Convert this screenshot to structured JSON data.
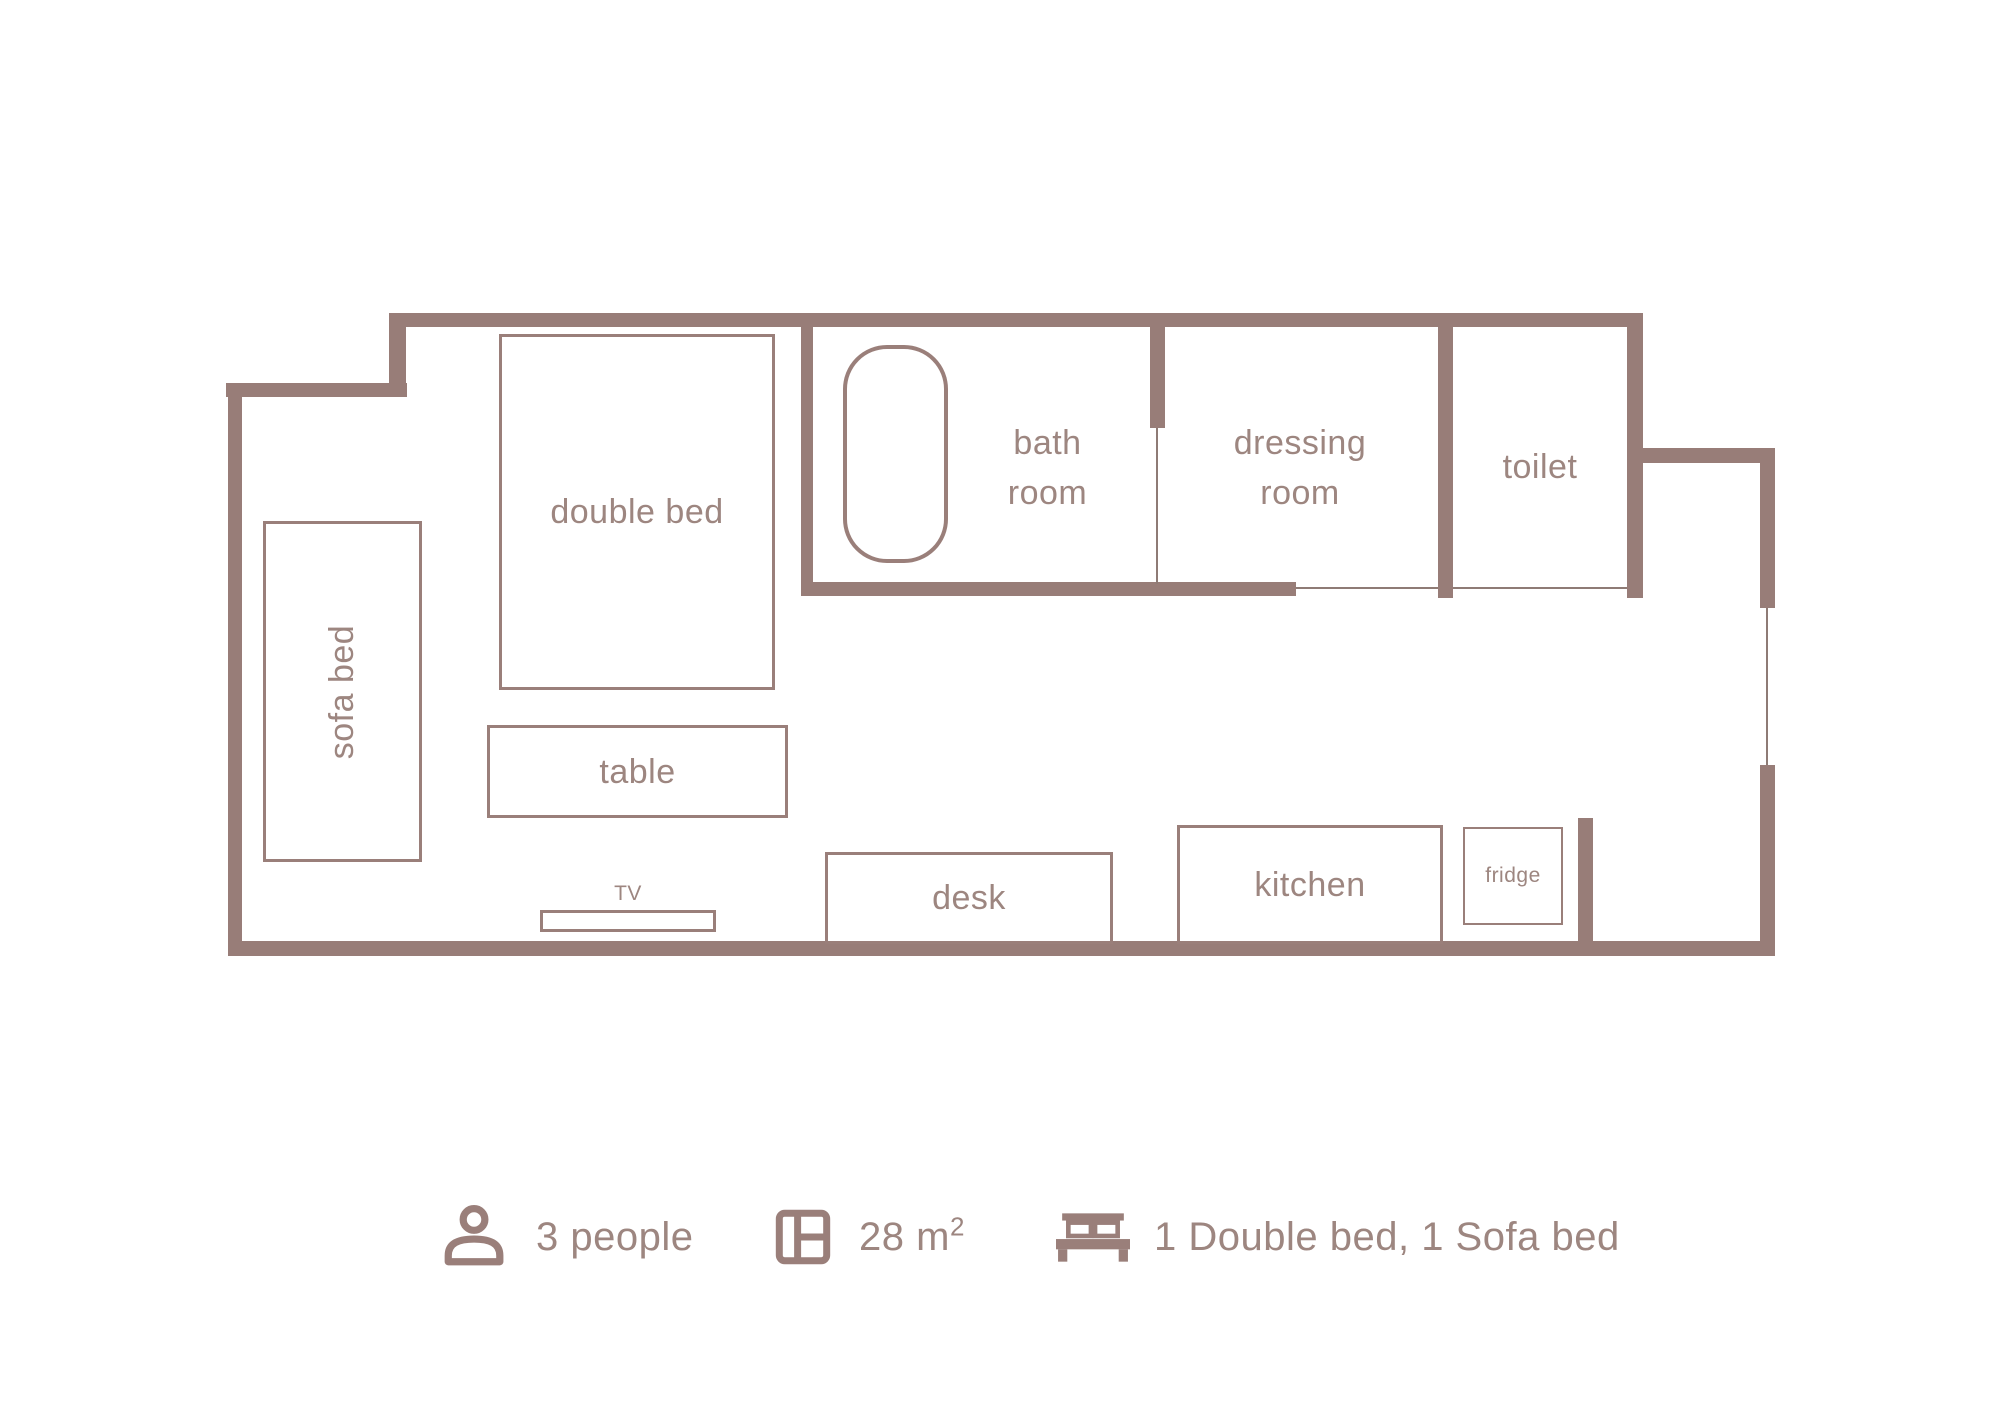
{
  "colors": {
    "wall": "#987d78",
    "furniture_border": "#9a7f7a",
    "text": "#9d8680",
    "background": "#ffffff"
  },
  "plan": {
    "rooms": [
      {
        "id": "bath-room",
        "label_lines": [
          "bath",
          "room"
        ]
      },
      {
        "id": "dressing-room",
        "label_lines": [
          "dressing",
          "room"
        ]
      },
      {
        "id": "toilet",
        "label_lines": [
          "toilet"
        ]
      }
    ],
    "furniture": [
      {
        "id": "sofa-bed",
        "label": "sofa bed"
      },
      {
        "id": "double-bed",
        "label": "double bed"
      },
      {
        "id": "table",
        "label": "table"
      },
      {
        "id": "tv",
        "label": "TV"
      },
      {
        "id": "desk",
        "label": "desk"
      },
      {
        "id": "kitchen",
        "label": "kitchen"
      },
      {
        "id": "fridge",
        "label": "fridge"
      }
    ],
    "fixtures": [
      {
        "id": "bathtub",
        "icon": "bathtub-icon"
      }
    ]
  },
  "info": {
    "capacity": {
      "icon": "person-icon",
      "label": "3 people"
    },
    "area": {
      "icon": "area-icon",
      "prefix": "28 m",
      "sup": "2"
    },
    "beds": {
      "icon": "bed-icon",
      "label": "1 Double bed, 1 Sofa bed"
    }
  }
}
